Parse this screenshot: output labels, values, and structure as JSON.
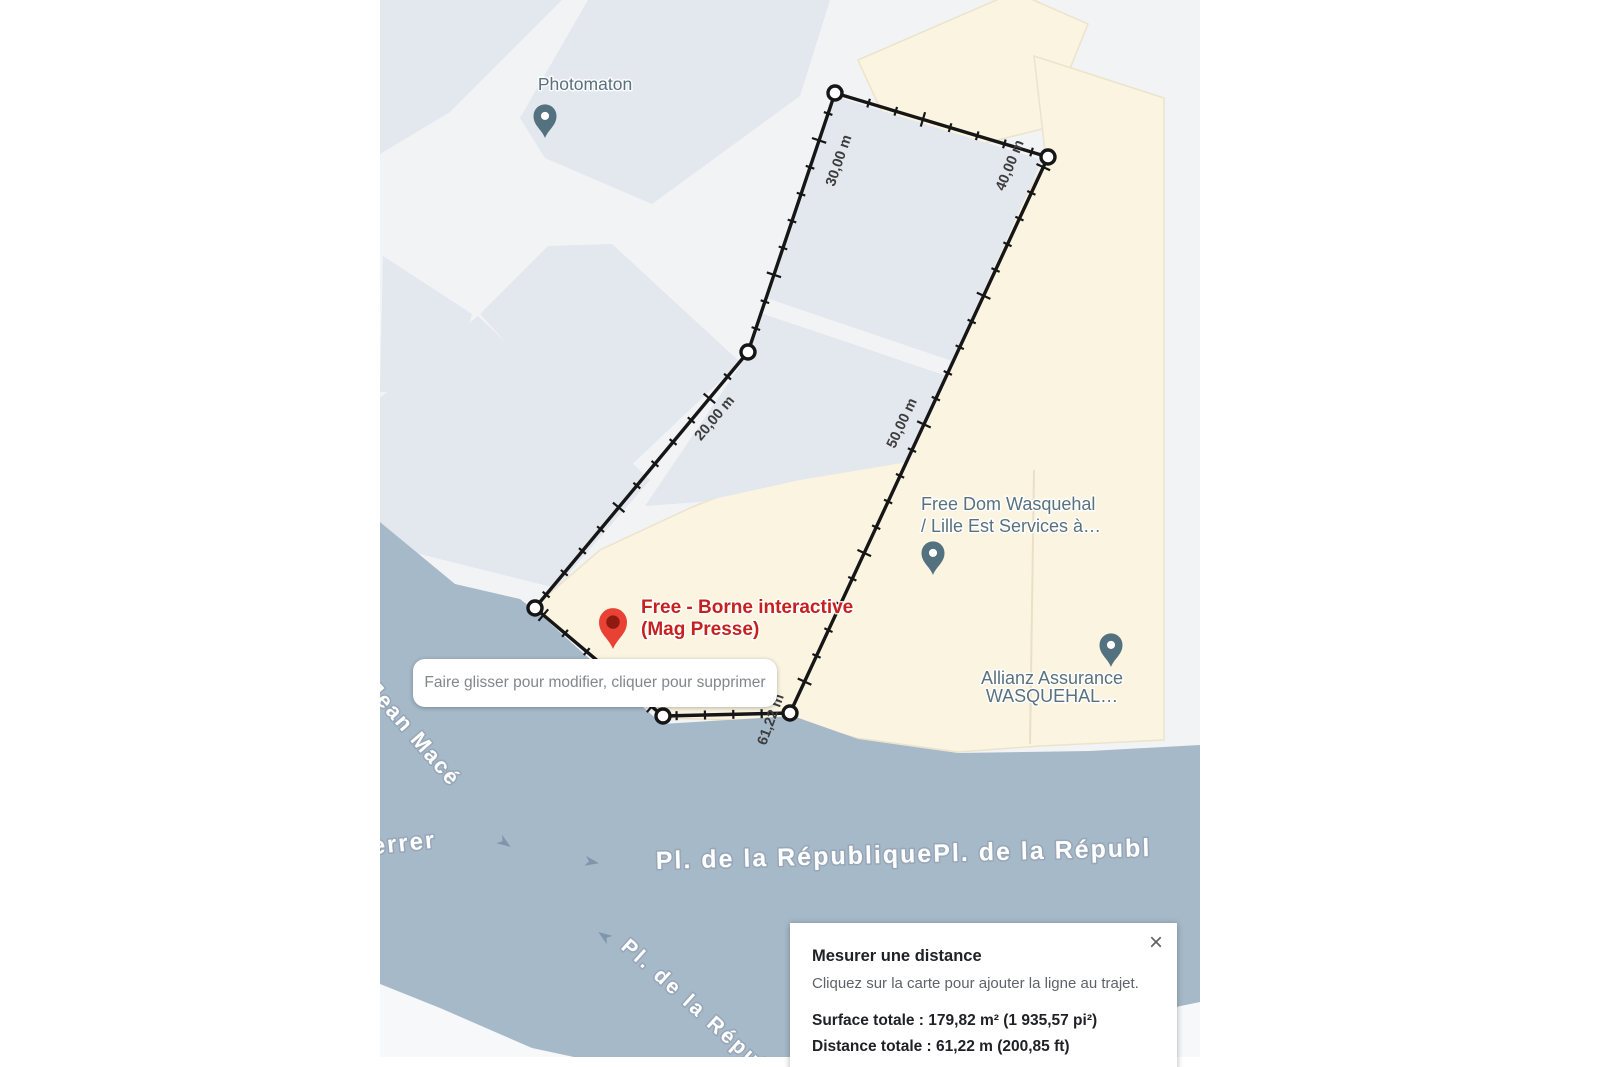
{
  "map": {
    "colors": {
      "water": "#a6b9c9",
      "building_gray": "#e3e7ee",
      "building_beige": "#faf4e1",
      "road": "#f1f3f5",
      "measure_line": "#161616",
      "poi_slate": "#53717f",
      "poi_red": "#e94235",
      "poi_red_text": "#c5221f"
    },
    "measurement": {
      "total_m": 61.22,
      "vertices": [
        [
          790,
          713
        ],
        [
          663,
          716
        ],
        [
          535,
          608
        ],
        [
          748,
          352
        ],
        [
          835,
          93
        ],
        [
          1048,
          157
        ]
      ],
      "distance_labels": [
        {
          "text": "20,00 m",
          "x": 718,
          "y": 421,
          "rot": -50
        },
        {
          "text": "30,00 m",
          "x": 843,
          "y": 162,
          "rot": -71
        },
        {
          "text": "40,00 m",
          "x": 1014,
          "y": 167,
          "rot": -68
        },
        {
          "text": "50,00 m",
          "x": 906,
          "y": 425,
          "rot": -65
        },
        {
          "text": "61,22 m",
          "x": 775,
          "y": 721,
          "rot": -70
        }
      ]
    },
    "pois": [
      {
        "id": "photomaton",
        "lines": [
          "Photomaton"
        ],
        "pin": [
          545,
          138
        ],
        "pin_color": "#53717f",
        "pin_scale": 0.92,
        "inner_color": "#ffffff",
        "inner_r": 4.4,
        "label_x": 585,
        "label_y": 90,
        "anchor": "middle",
        "size": 17.5,
        "weight": 500,
        "color": "#58727f",
        "line_h": 22
      },
      {
        "id": "free-dom",
        "lines": [
          "Free Dom Wasquehal",
          "/ Lille Est Services à…"
        ],
        "pin": [
          933,
          575
        ],
        "pin_color": "#53717f",
        "pin_scale": 0.92,
        "inner_color": "#ffffff",
        "inner_r": 4.4,
        "label_x": 921,
        "label_y": 510,
        "anchor": "start",
        "size": 18,
        "weight": 500,
        "color": "#58727f",
        "line_h": 22
      },
      {
        "id": "allianz",
        "lines": [
          "Allianz Assurance",
          "WASQUEHAL…"
        ],
        "pin": [
          1111,
          667
        ],
        "pin_color": "#53717f",
        "pin_scale": 0.92,
        "inner_color": "#ffffff",
        "inner_r": 4.4,
        "label_x": 1052,
        "label_y": 684,
        "anchor": "middle",
        "size": 18,
        "weight": 500,
        "color": "#58727f",
        "line_h": 18
      },
      {
        "id": "free-borne",
        "lines": [
          "Free - Borne interactive",
          "(Mag Presse)"
        ],
        "pin": [
          613,
          649
        ],
        "pin_color": "#e94235",
        "pin_scale": 1.12,
        "inner_color": "#8f1a10",
        "inner_r": 6,
        "label_x": 641,
        "label_y": 613,
        "anchor": "start",
        "size": 19,
        "weight": 600,
        "color": "#c5221f",
        "line_h": 22
      }
    ],
    "streets": [
      {
        "text": "Jean Macé",
        "x": 366,
        "y": 690,
        "rot": 49,
        "size": 22,
        "ls": 2
      },
      {
        "text": "Ferrer",
        "x": 356,
        "y": 856,
        "rot": -6,
        "size": 24,
        "ls": 2
      },
      {
        "text": "Pl. de la RépubliquePl. de la Républ",
        "x": 656,
        "y": 869,
        "rot": -1.5,
        "size": 25,
        "ls": 2
      },
      {
        "text": "Pl. de la Répub",
        "x": 620,
        "y": 948,
        "rot": 42,
        "size": 21,
        "ls": 3
      }
    ],
    "arrows": [
      {
        "x": 505,
        "y": 843,
        "rot": 35
      },
      {
        "x": 592,
        "y": 862,
        "rot": 10
      },
      {
        "x": 604,
        "y": 936,
        "rot": 215
      }
    ]
  },
  "tooltip": {
    "text": "Faire glisser pour modifier, cliquer pour supprimer"
  },
  "panel": {
    "title": "Mesurer une distance",
    "subtitle": "Cliquez sur la carte pour ajouter la ligne au trajet.",
    "surface_label": "Surface totale : 179,82 m² (1 935,57 pi²)",
    "distance_label": "Distance totale : 61,22 m (200,85 ft)",
    "close_icon": "×"
  }
}
